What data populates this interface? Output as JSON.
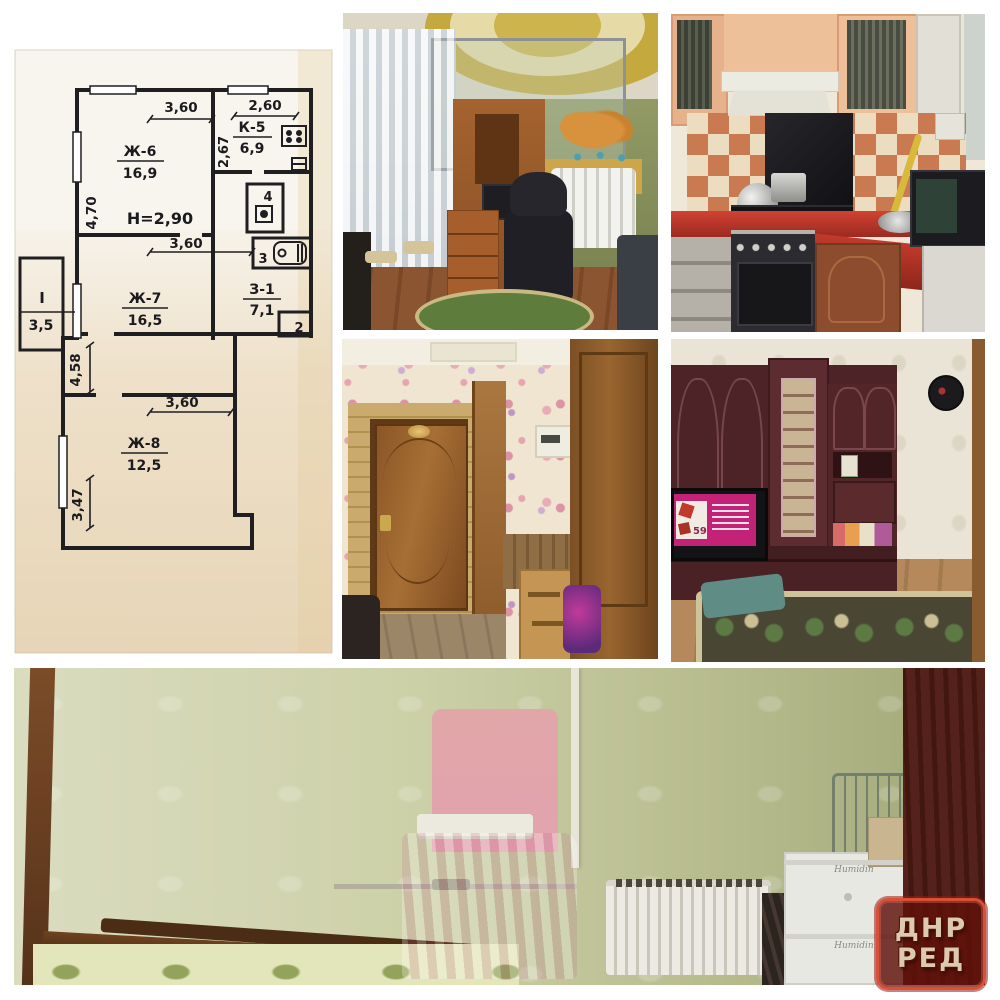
{
  "watermark": {
    "line1": "ДНР",
    "line2": "РЕД"
  },
  "floor_plan": {
    "height_note": "H=2,90",
    "rooms": {
      "room6": {
        "id": "Ж-6",
        "area": "16,9"
      },
      "kitchen": {
        "id": "К-5",
        "area": "6,9"
      },
      "room7": {
        "id": "Ж-7",
        "area": "16,5"
      },
      "hall": {
        "id": "З-1",
        "area": "7,1"
      },
      "room8": {
        "id": "Ж-8",
        "area": "12,5"
      },
      "balcony": {
        "id": "I",
        "area": "3,5"
      },
      "wc": {
        "id": "4"
      },
      "bath": {
        "id": "3"
      },
      "closet": {
        "id": "2"
      }
    },
    "dims": {
      "room6_width": "3,60",
      "kitchen_width": "2,60",
      "kitchen_depth": "2,67",
      "room6_depth": "4,70",
      "room7_width": "3,60",
      "corridor_depth": "4,58",
      "room8_width": "3,60",
      "room8_depth": "3,47"
    }
  },
  "living_room_photo": {
    "tv_price": "59"
  },
  "bedroom_photo": {
    "box_label_top": "Humidin",
    "box_label_bottom": "Humidin"
  }
}
